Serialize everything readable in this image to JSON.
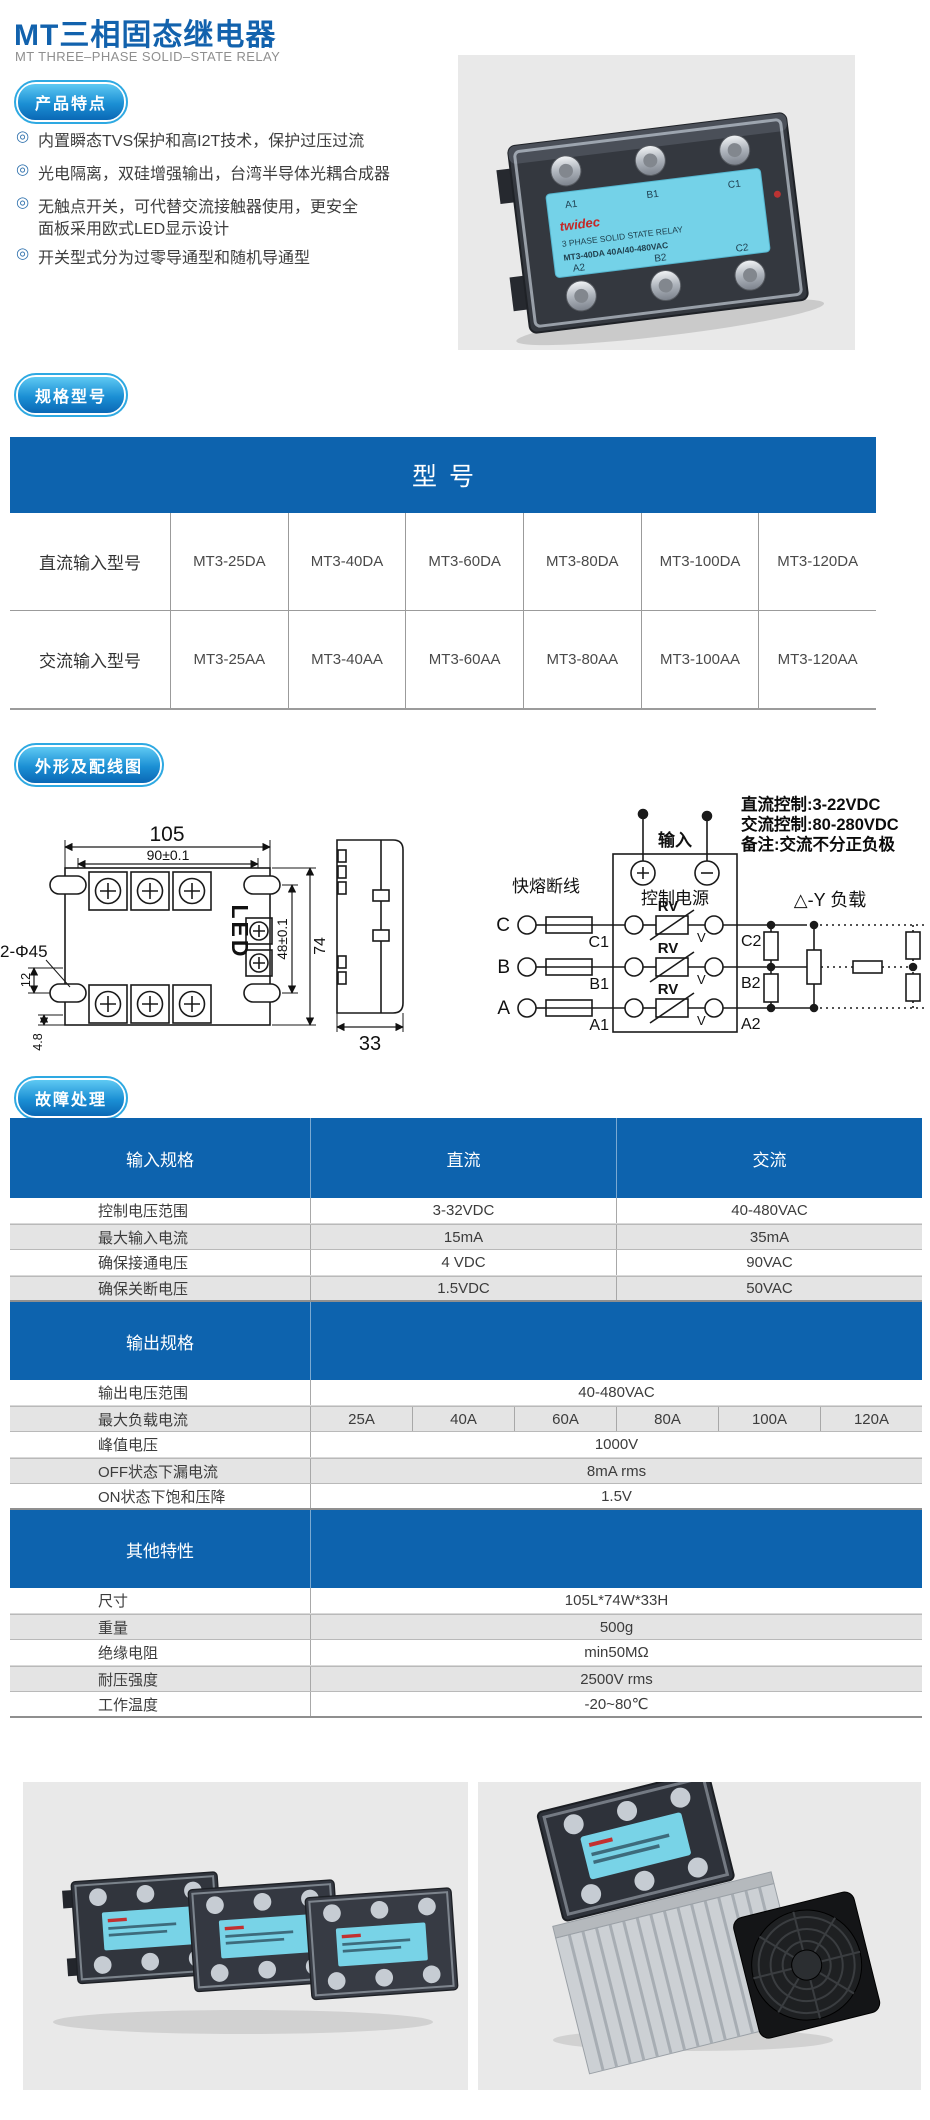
{
  "page": {
    "title": "MT三相固态继电器",
    "subtitle": "MT THREE–PHASE SOLID–STATE RELAY"
  },
  "features": {
    "badge": "产品特点",
    "items": [
      {
        "bullet": "◎",
        "text": "内置瞬态TVS保护和高I2T技术，保护过压过流"
      },
      {
        "bullet": "◎",
        "text": "光电隔离，双硅增强输出，台湾半导体光耦合成器"
      },
      {
        "bullet": "◎",
        "text": "无触点开关，可代替交流接触器使用，更安全"
      },
      {
        "bullet": "",
        "text": "面板采用欧式LED显示设计"
      },
      {
        "bullet": "◎",
        "text": "开关型式分为过零导通型和随机导通型"
      }
    ]
  },
  "models": {
    "badge": "规格型号",
    "header": "型号",
    "rows": [
      {
        "label": "直流输入型号",
        "models": [
          "MT3-25DA",
          "MT3-40DA",
          "MT3-60DA",
          "MT3-80DA",
          "MT3-100DA",
          "MT3-120DA"
        ]
      },
      {
        "label": "交流输入型号",
        "models": [
          "MT3-25AA",
          "MT3-40AA",
          "MT3-60AA",
          "MT3-80AA",
          "MT3-100AA",
          "MT3-120AA"
        ]
      }
    ]
  },
  "outline": {
    "badge": "外形及配线图",
    "front": {
      "w_outer": "105",
      "w_inner": "90±0.1",
      "h_outer": "74",
      "h_inner": "48±0.1",
      "offset1": "12",
      "offset2": "4.8",
      "holes": "2-Φ45",
      "led": "LED"
    },
    "side": {
      "depth": "33"
    }
  },
  "wiring": {
    "notes": [
      "直流控制:3-22VDC",
      "交流控制:80-280VDC",
      "备注:交流不分正负极"
    ],
    "input": "输入",
    "control": "控制电源",
    "fuse": "快熔断线",
    "load": "△-Y 负载",
    "rv": "RV",
    "v": "V",
    "phases": [
      "C",
      "B",
      "A"
    ],
    "in_terminals": [
      "C1",
      "B1",
      "A1"
    ],
    "out_terminals": [
      "C2",
      "B2",
      "A2"
    ]
  },
  "faults": {
    "badge": "故障处理"
  },
  "spec": {
    "input": {
      "header": [
        "输入规格",
        "直流",
        "交流"
      ],
      "rows": [
        {
          "label": "控制电压范围",
          "dc": "3-32VDC",
          "ac": "40-480VAC"
        },
        {
          "label": "最大输入电流",
          "dc": "15mA",
          "ac": "35mA"
        },
        {
          "label": "确保接通电压",
          "dc": "4 VDC",
          "ac": "90VAC"
        },
        {
          "label": "确保关断电压",
          "dc": "1.5VDC",
          "ac": "50VAC"
        }
      ]
    },
    "output": {
      "header": "输出规格",
      "rows": [
        {
          "label": "输出电压范围",
          "value": "40-480VAC"
        },
        {
          "label": "最大负载电流",
          "values": [
            "25A",
            "40A",
            "60A",
            "80A",
            "100A",
            "120A"
          ]
        },
        {
          "label": "峰值电压",
          "value": "1000V"
        },
        {
          "label": "OFF状态下漏电流",
          "value": "8mA rms"
        },
        {
          "label": "ON状态下饱和压降",
          "value": "1.5V"
        }
      ]
    },
    "other": {
      "header": "其他特性",
      "rows": [
        {
          "label": "尺寸",
          "value": "105L*74W*33H"
        },
        {
          "label": "重量",
          "value": "500g"
        },
        {
          "label": "绝缘电阻",
          "value": "min50MΩ"
        },
        {
          "label": "耐压强度",
          "value": "2500V rms"
        },
        {
          "label": "工作温度",
          "value": "-20~80℃"
        }
      ]
    }
  },
  "photo": {
    "brand": "twidec",
    "line1": "3 PHASE  SOLID STATE RELAY",
    "line2": "MT3-40DA    40A/40-480VAC",
    "top_terminals": [
      "A1",
      "B1",
      "C1"
    ],
    "bottom_terminals": [
      "A2",
      "B2",
      "C2"
    ]
  },
  "colors": {
    "accent": "#0d63ae",
    "badge_ring": "#2ea9e2",
    "photo_bg": "#e9e9e9",
    "row_alt": "#e4e4e4",
    "label_cyan": "#74d2e8"
  }
}
